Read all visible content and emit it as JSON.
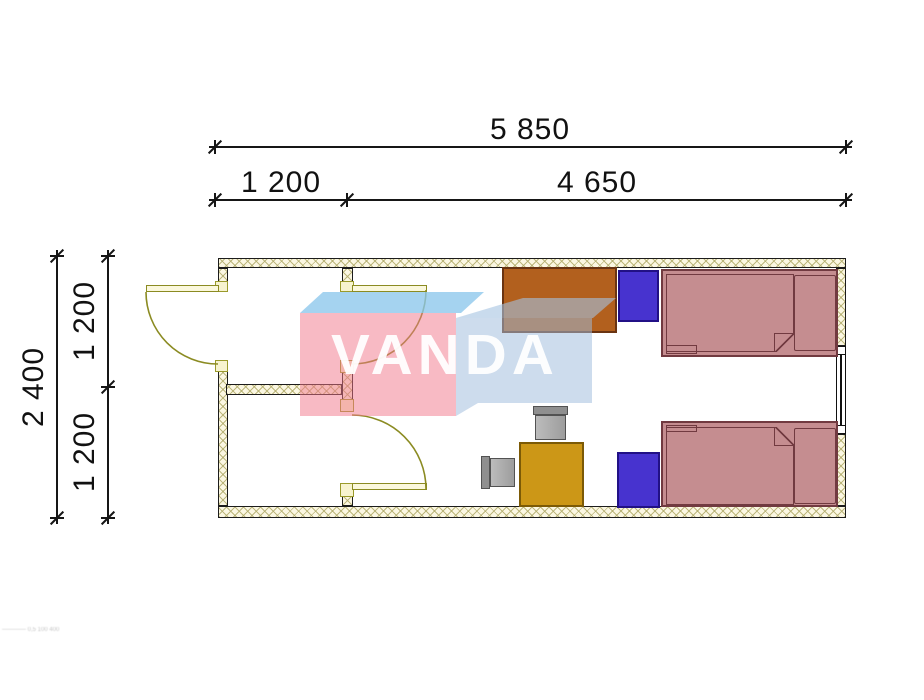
{
  "drawing_type": "cabin floor plan 5850 x 2400",
  "dims": {
    "overall_width": "5 850",
    "entry_width": "1 200",
    "room_width": "4 650",
    "overall_depth": "2 400",
    "upper_bay_depth": "1 200",
    "lower_bay_depth": "1 200"
  },
  "watermark": {
    "text": "VANDA",
    "front_color": "#f27a8c",
    "top_color": "#8cc6ec",
    "side_color": "#a0bcdc"
  },
  "footer": {
    "note": "———— 0,5 100 400"
  },
  "plan": {
    "wall_fill": "#fbf7e2",
    "door_color": "#8b8b22",
    "furniture": [
      {
        "name": "desk",
        "color": "#b2601e"
      },
      {
        "name": "wardrobe-top",
        "color": "#4733cf"
      },
      {
        "name": "bed-top",
        "color": "#c58d90"
      },
      {
        "name": "wardrobe-bottom",
        "color": "#4733cf"
      },
      {
        "name": "bed-bottom",
        "color": "#c58d90"
      },
      {
        "name": "square-table",
        "color": "#cc9717"
      },
      {
        "name": "chair-top",
        "color": "#9d9d9d"
      },
      {
        "name": "chair-left",
        "color": "#9d9d9d"
      }
    ]
  }
}
